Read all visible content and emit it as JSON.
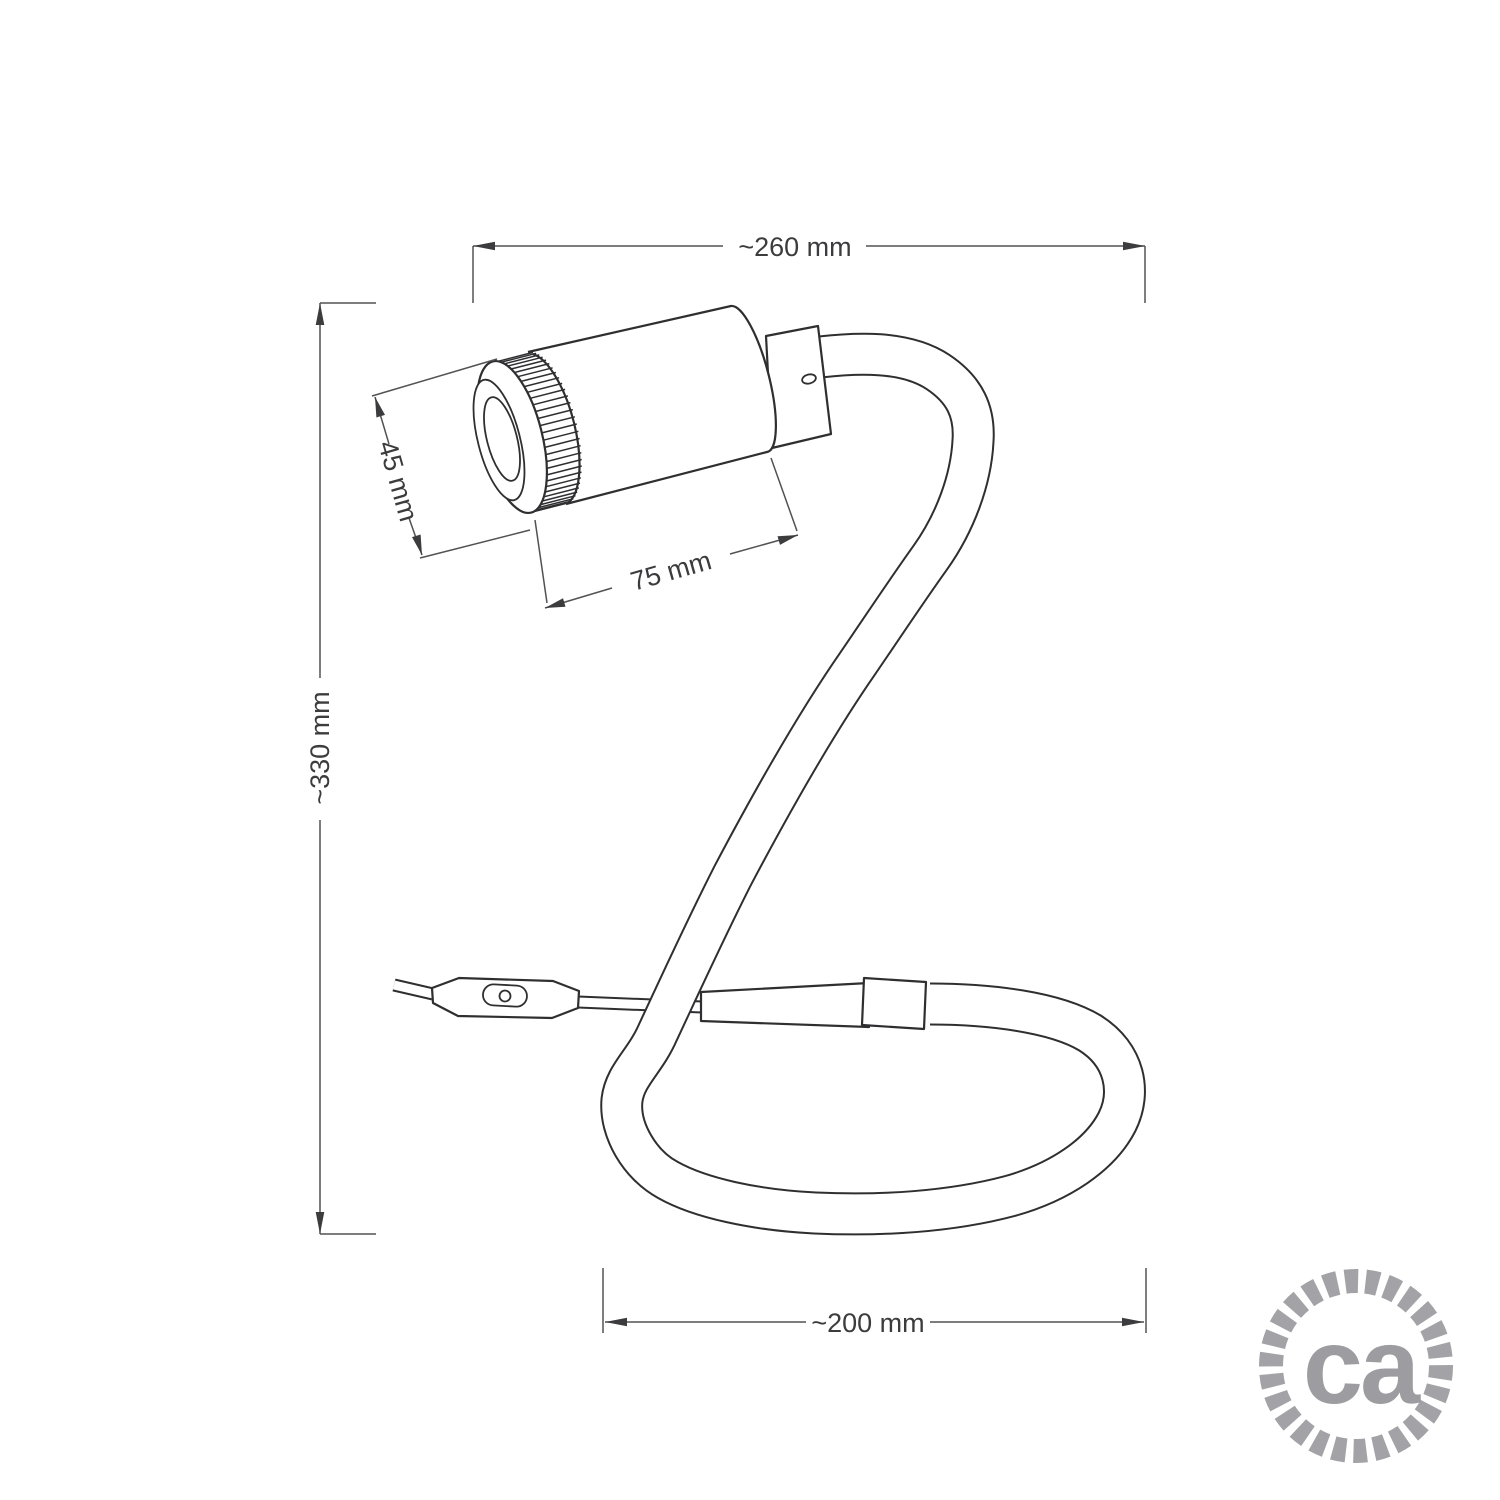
{
  "diagram": {
    "title": "Gooseneck spot lamp dimension drawing",
    "line_color": "#2f2f31",
    "dim_color": "#525254",
    "text_color": "#3c3c3e",
    "dimensions": {
      "total_width": {
        "label": "~260 mm",
        "value_mm": 260,
        "approx": true
      },
      "total_height": {
        "label": "~330 mm",
        "value_mm": 330,
        "approx": true
      },
      "head_diameter": {
        "label": "45 mm",
        "value_mm": 45,
        "approx": false
      },
      "head_length": {
        "label": "75 mm",
        "value_mm": 75,
        "approx": false
      },
      "loop_width": {
        "label": "~200 mm",
        "value_mm": 200,
        "approx": true
      }
    },
    "parts": [
      "spotlight head",
      "knurled ring",
      "lens",
      "adapter joint",
      "set screw",
      "flexible gooseneck tube",
      "cable ferrule",
      "collar",
      "inline switch",
      "power cable"
    ]
  },
  "logo": {
    "text": "ca",
    "text_color": "#9d9da1",
    "ring_color": "#a3a3a7"
  }
}
